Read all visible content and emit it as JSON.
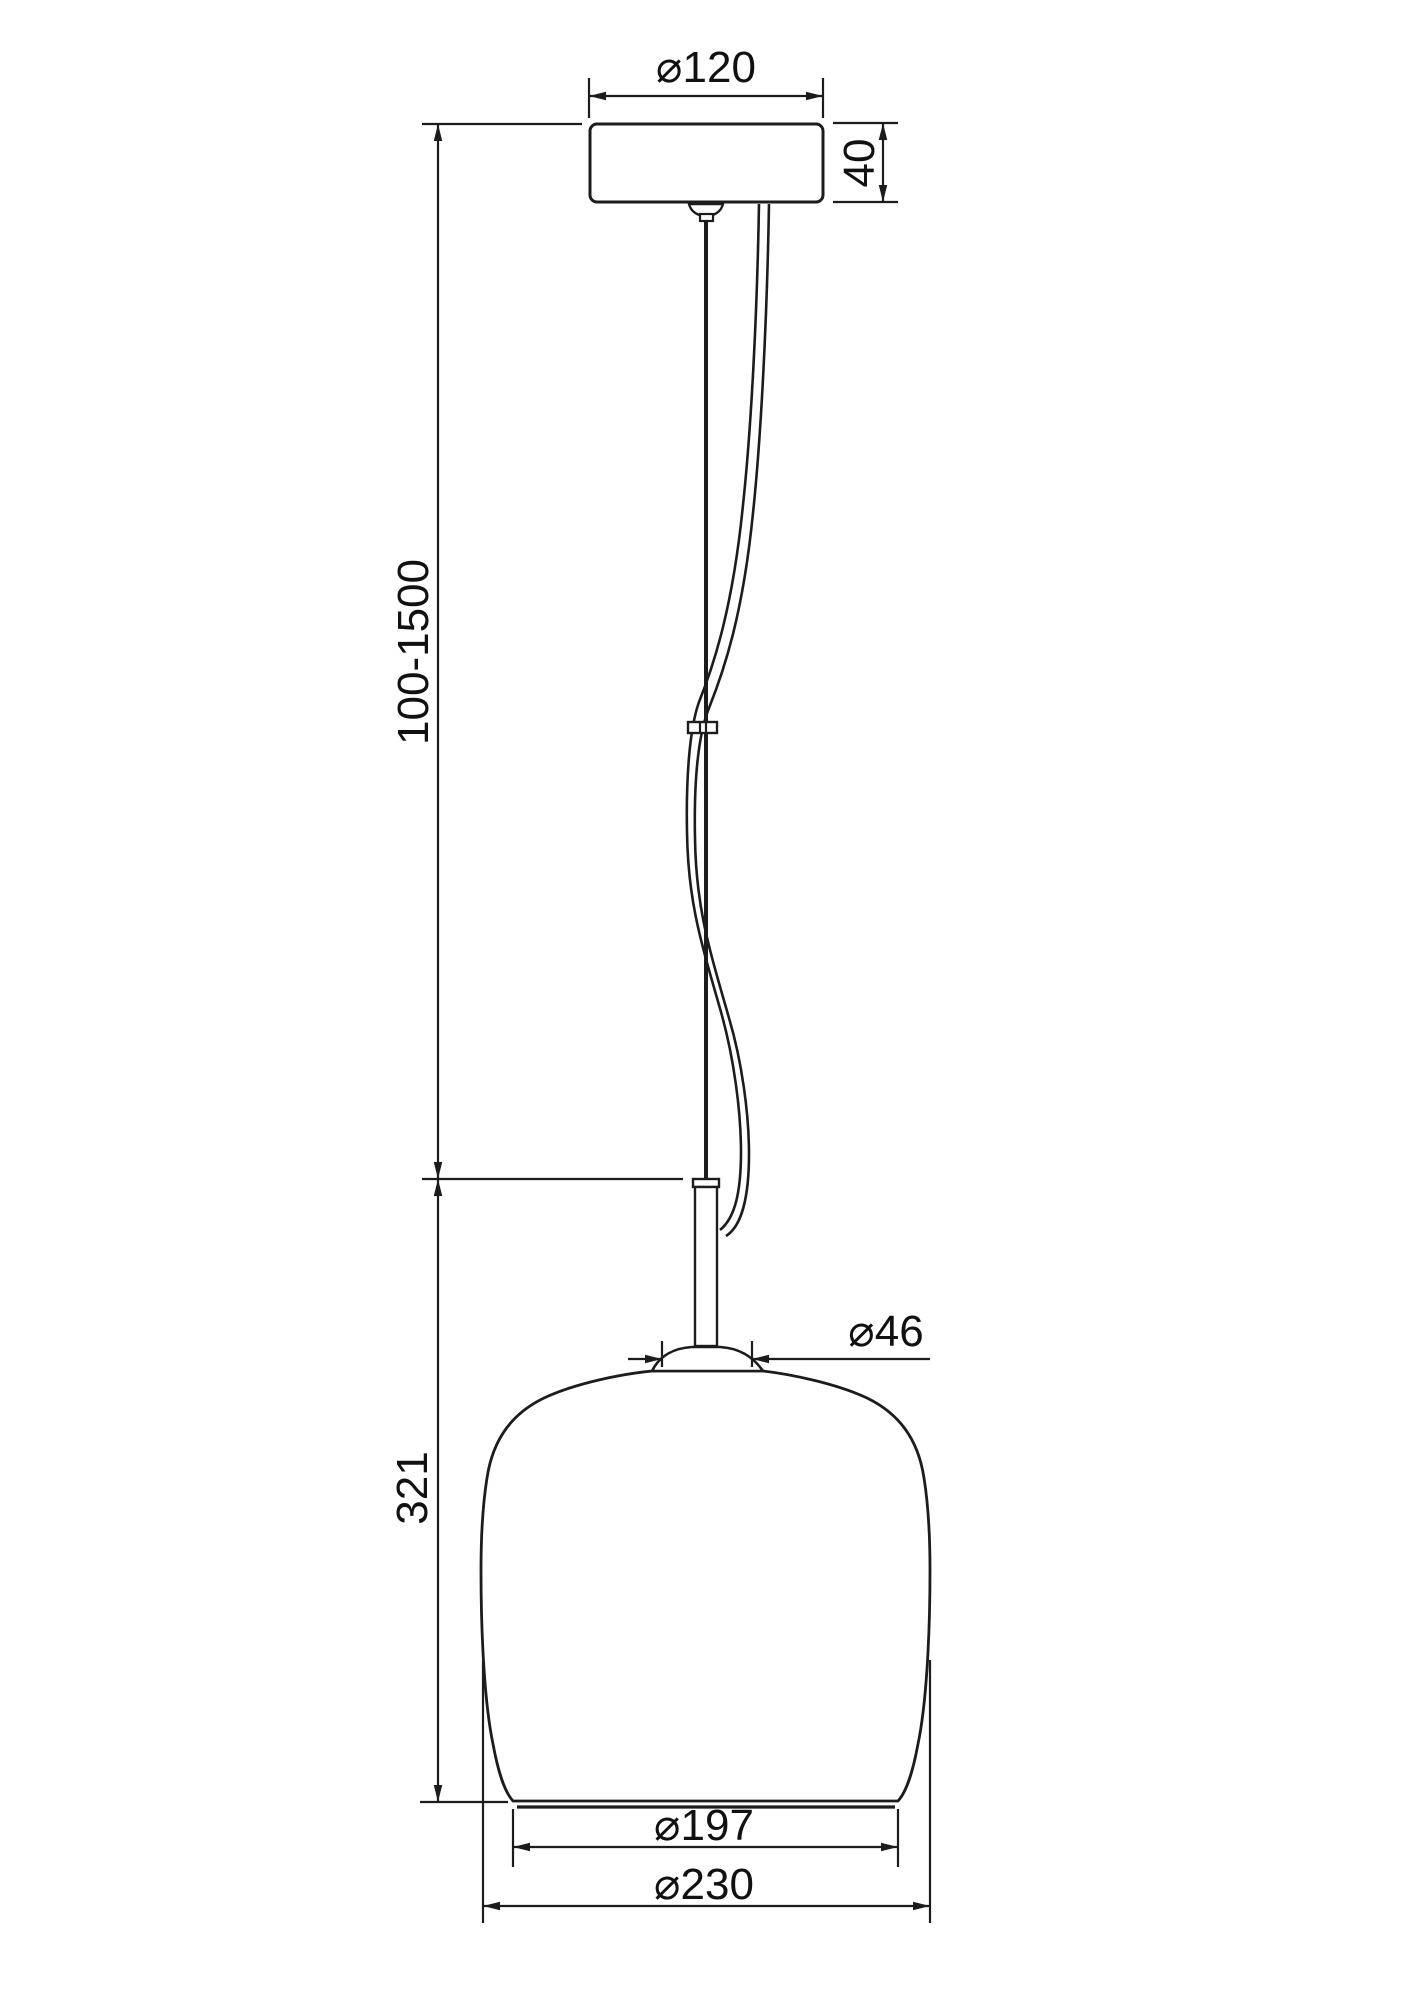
{
  "drawing": {
    "description": "Pendant lamp technical dimension drawing, front view",
    "background_color": "#ffffff",
    "line_color": "#1c1c1c",
    "text_color": "#111111",
    "labels": {
      "canopy_diameter": "⌀120",
      "canopy_height": "40",
      "suspension_height_range": "100-1500",
      "neck_diameter": "⌀46",
      "shade_height": "321",
      "shade_opening_diameter": "⌀197",
      "shade_max_diameter": "⌀230"
    }
  }
}
